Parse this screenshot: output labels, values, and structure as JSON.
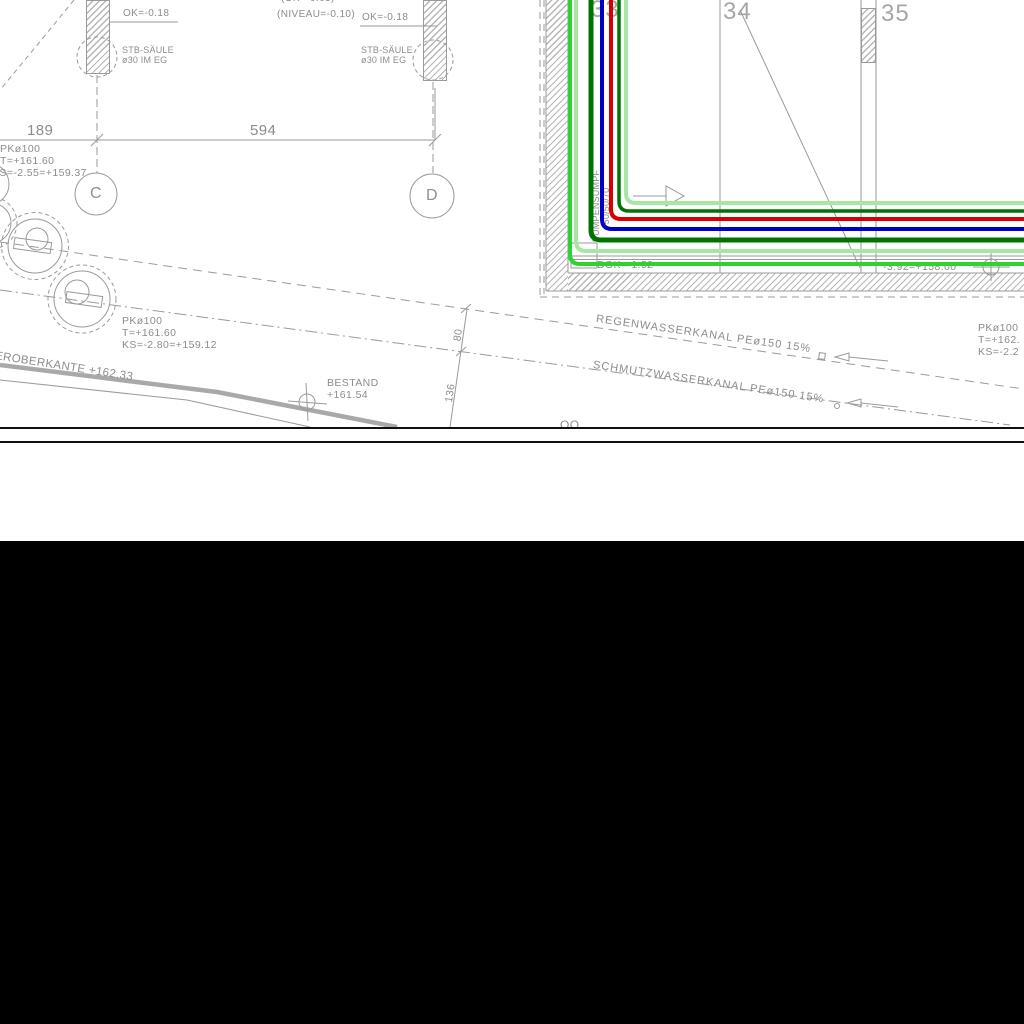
{
  "colors": {
    "line_gray": "#9a9a9a",
    "text_gray": "#8c8c8c",
    "hatch_gray": "#b6b6b6",
    "pipe_pale_green": "#a6e7a6",
    "pipe_bright_green": "#2fd32f",
    "pipe_dark_green": "#007300",
    "pipe_blue": "#0000c8",
    "pipe_red": "#d60000"
  },
  "plan": {
    "note_top": "(OK=-0.63)",
    "note_niveau": "(NIVEAU=-0.10)",
    "col_left_ok": "OK=-0.18",
    "col_left_type": "STB-SÄULE",
    "col_left_size": "ø30 IM EG",
    "col_mid_ok": "OK=-0.18",
    "col_mid_type": "STB-SÄULE",
    "col_mid_size": "ø30 IM EG",
    "dim_c_d_left": "189",
    "dim_c_d_right": "594",
    "axis_c": "C",
    "axis_d": "D",
    "axis_33": "33",
    "axis_34": "34",
    "axis_35": "35",
    "mh1_line1": "PKø100",
    "mh1_line2": "T=+161.60",
    "mh1_line3": "KS=-2.55=+159.37",
    "mh2_line1": "PKø100",
    "mh2_line2": "T=+161.60",
    "mh2_line3": "KS=-2.80=+159.12",
    "mh3_line1": "PKø100",
    "mh3_line2": "T=+162.",
    "mh3_line3": "KS=-2.2",
    "wall_top_label": "EROBERKANTE +162.33",
    "bestand_line1": "BESTAND",
    "bestand_line2": "+161.54",
    "rain_sewer_label": "REGENWASSERKANAL PEø150 15%",
    "waste_sewer_label": "SCHMUTZWASSERKANAL PEø150 15%",
    "dim_80": "80",
    "dim_136": "136",
    "sump_line1": "PUMPENSUMPF",
    "sump_line2": "50/50/70",
    "sump_level": "DOK=-1.52",
    "pit_level": "-3.92=+158.00",
    "clipped_bottom": "OO"
  }
}
